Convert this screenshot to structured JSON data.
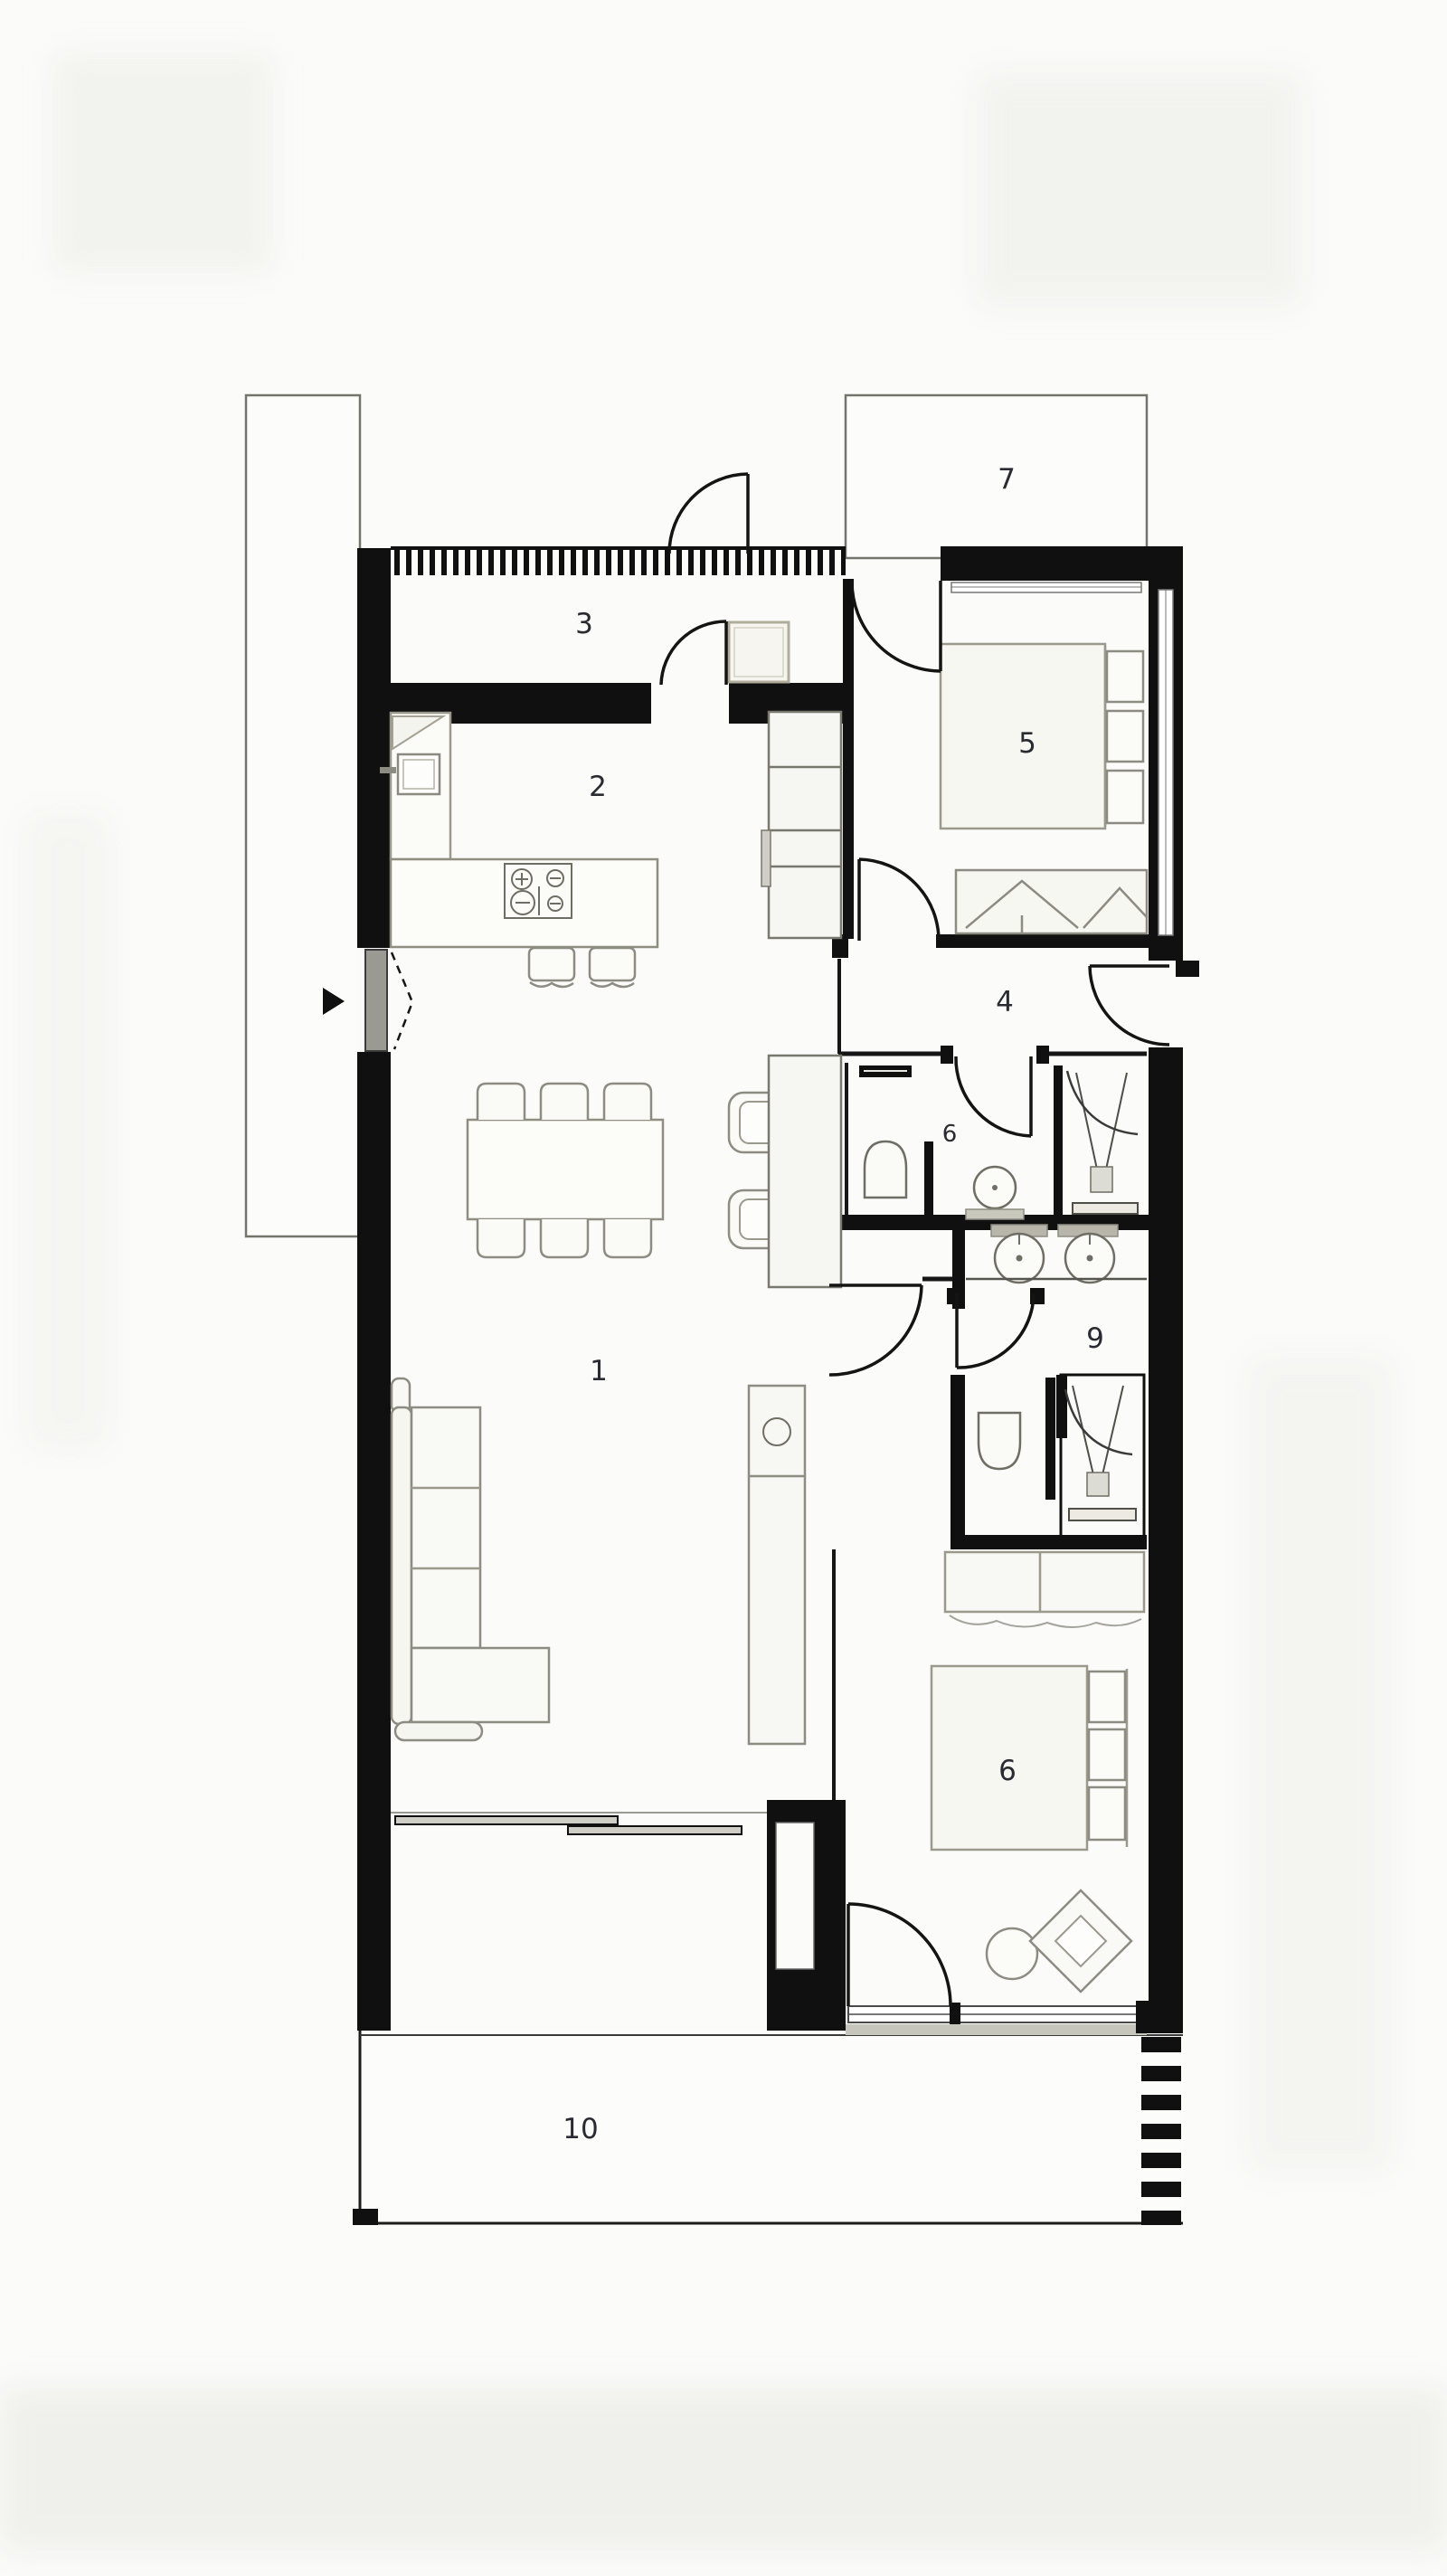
{
  "title": "Apartment floor plan",
  "rooms": {
    "living": "1",
    "kitchen": "2",
    "entry": "3",
    "hallway": "4",
    "bedroom_top": "5",
    "bathroom": "6",
    "terrace_top": "7",
    "dressing": "9",
    "bedroom_bottom": "6",
    "terrace_bottom": "10"
  },
  "colors": {
    "wall": "#101010",
    "paper": "#fbfbf9",
    "furniture_stroke": "#8d8c82",
    "accent_tan": "#b0ad9c",
    "sill_gray": "#c7c6bc",
    "glass_gray": "#cfcec6"
  }
}
